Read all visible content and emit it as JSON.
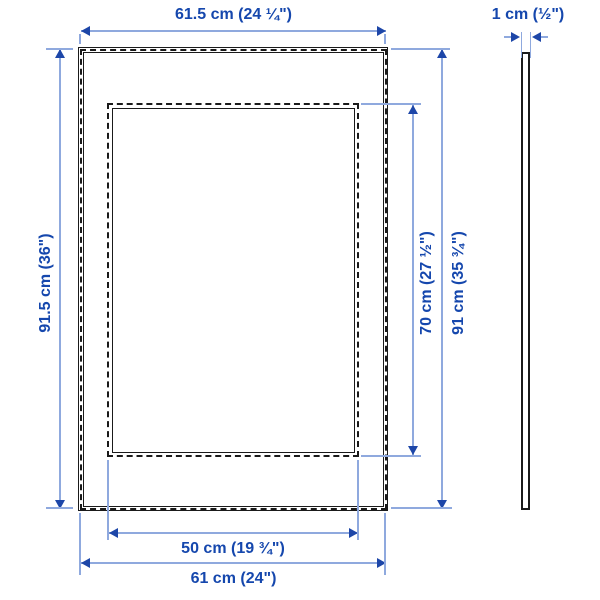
{
  "title": "Picture frame dimensions diagram",
  "front_view": {
    "outer_width_top": "61.5 cm (24 ¼\")",
    "outer_height_left": "91.5 cm (36\")",
    "opening_height": "70 cm (27 ½\")",
    "outer_height_right": "91 cm (35 ¾\")",
    "opening_width": "50 cm (19 ¾\")",
    "outer_width_bottom": "61 cm (24\")"
  },
  "side_view": {
    "thickness": "1 cm (½\")"
  },
  "colors": {
    "dimension_text": "#1547ad",
    "dimension_line": "#8fa9de",
    "arrowhead": "#1d46a8",
    "outline": "#1a1a1a",
    "background": "#ffffff"
  }
}
